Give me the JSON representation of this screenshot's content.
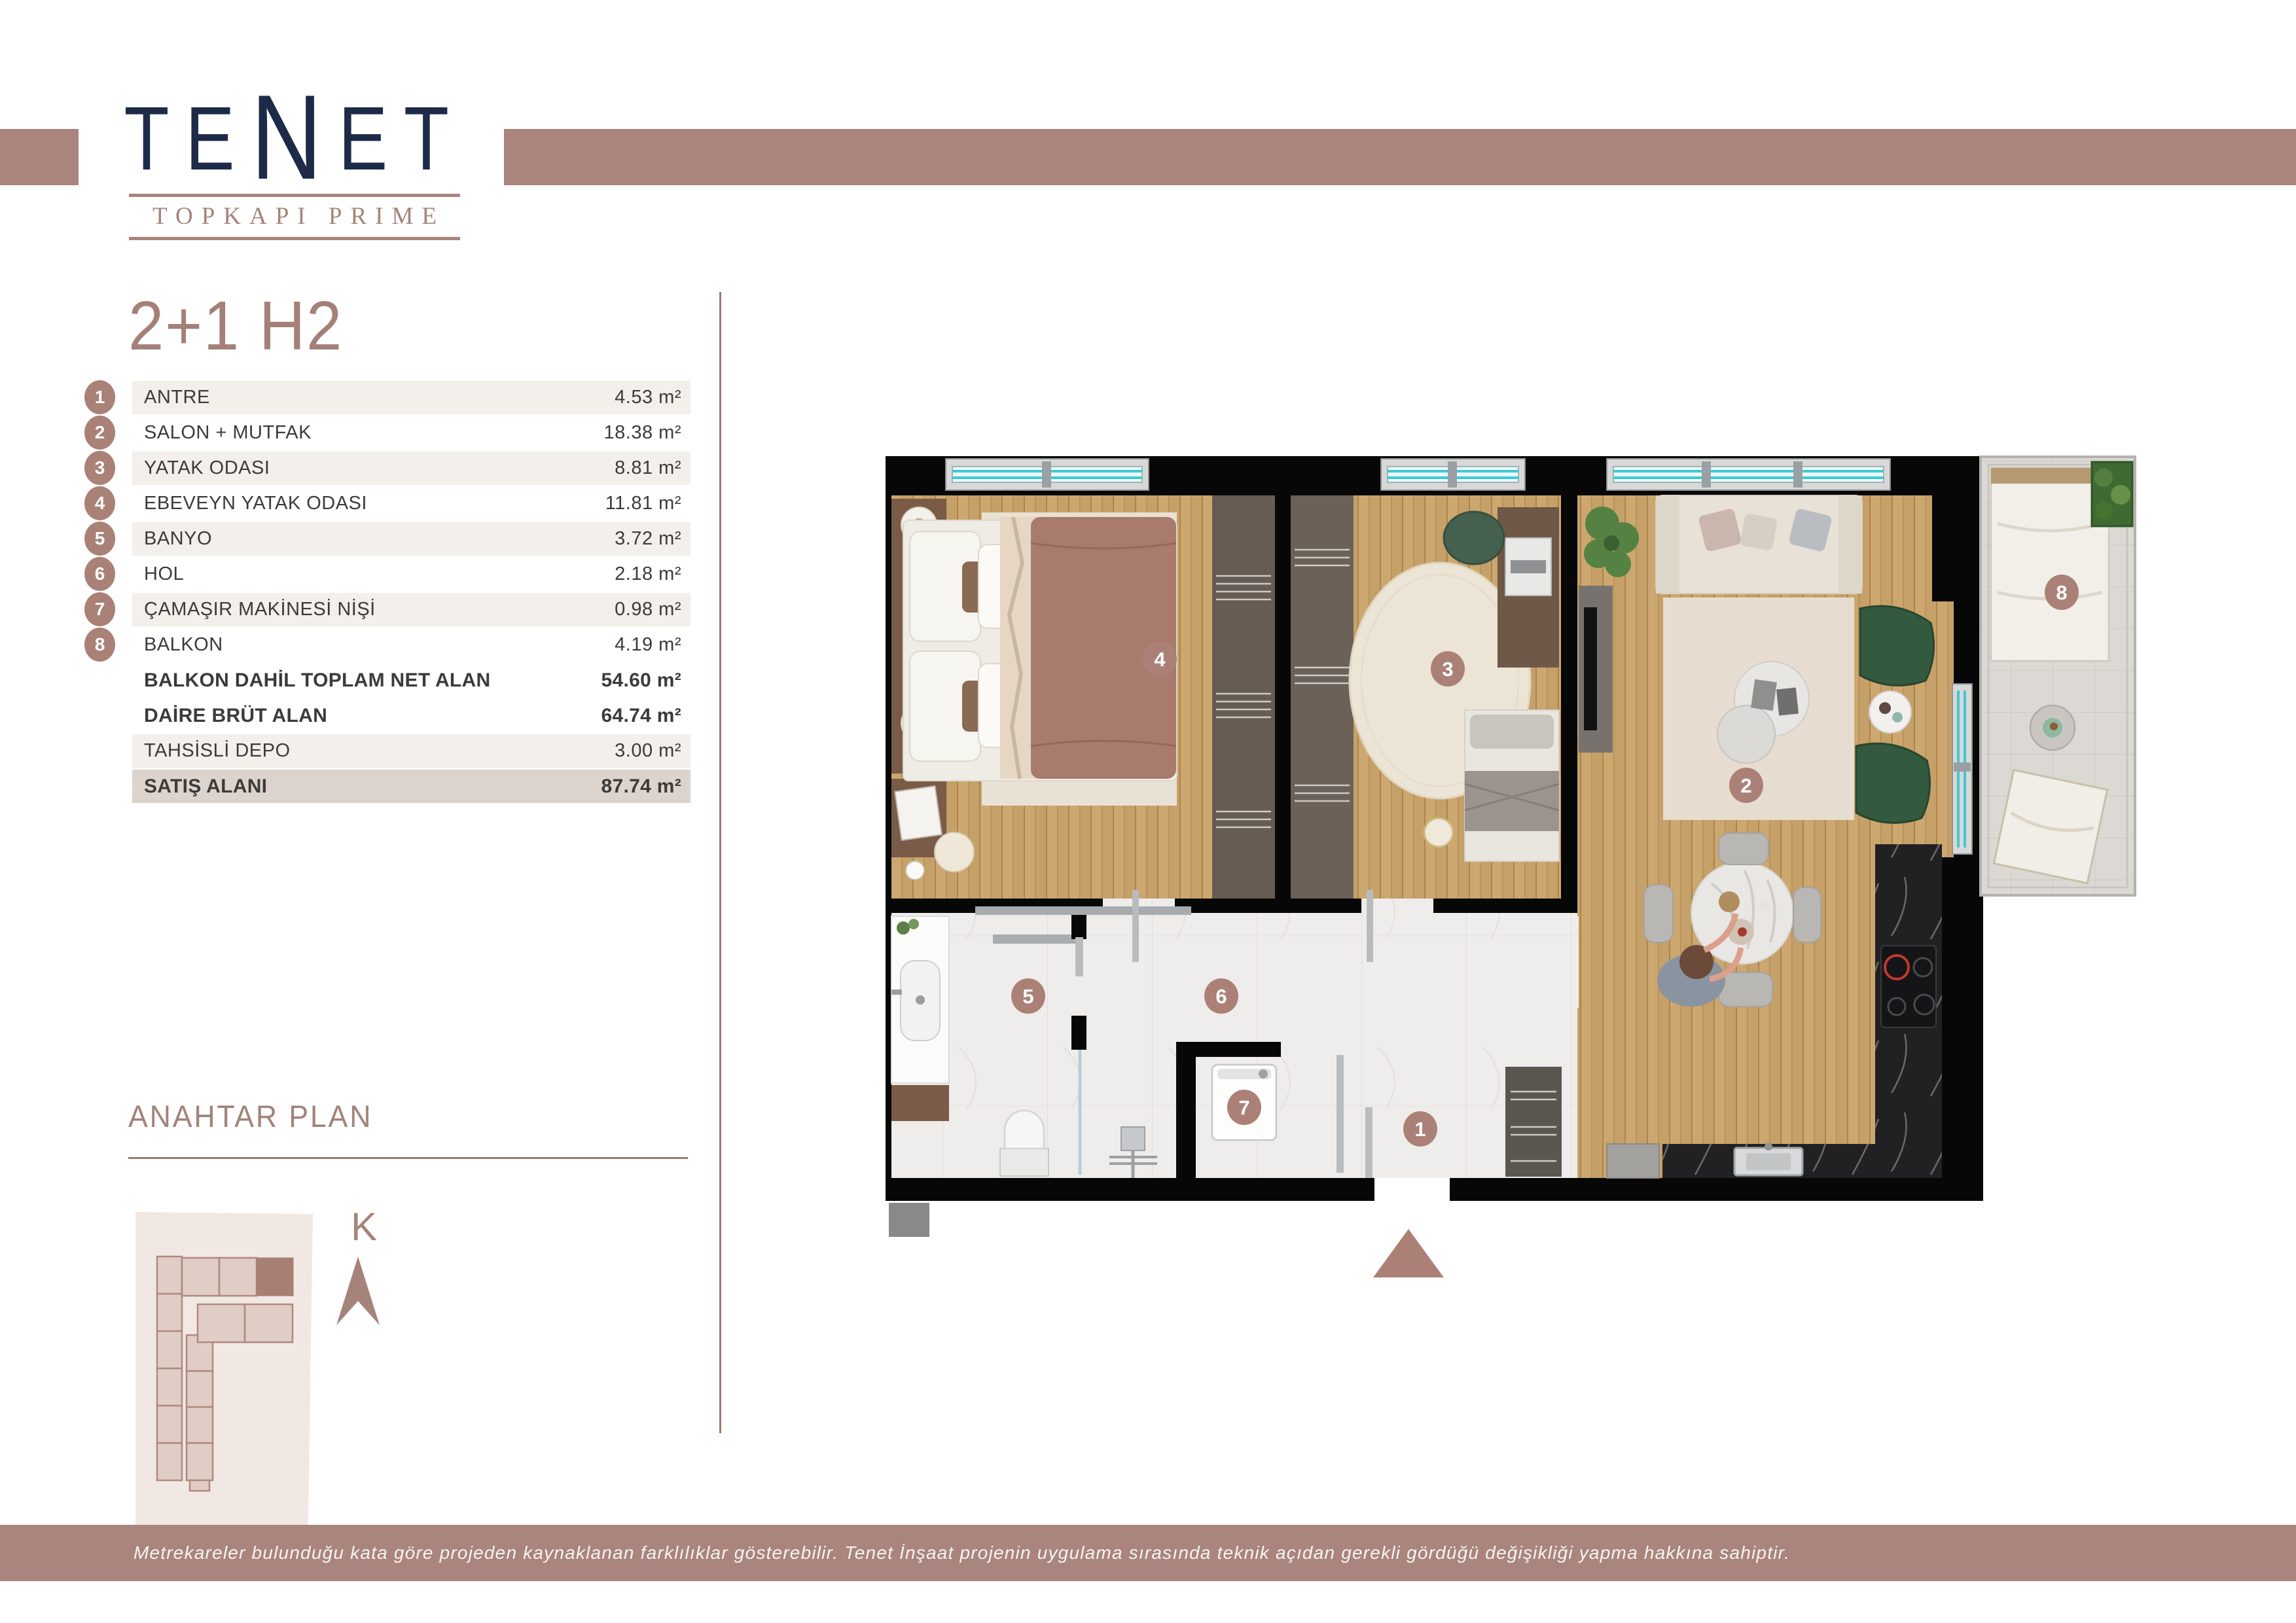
{
  "logo": {
    "brand_letters": [
      "T",
      "E",
      "N",
      "E",
      "T"
    ],
    "sub": "TOPKAPI PRIME"
  },
  "title": "2+1 H2",
  "table": {
    "rows": [
      {
        "num": "1",
        "label": "ANTRE",
        "value": "4.53 m²"
      },
      {
        "num": "2",
        "label": "SALON + MUTFAK",
        "value": "18.38 m²"
      },
      {
        "num": "3",
        "label": "YATAK ODASI",
        "value": "8.81 m²"
      },
      {
        "num": "4",
        "label": "EBEVEYN YATAK ODASI",
        "value": "11.81 m²"
      },
      {
        "num": "5",
        "label": "BANYO",
        "value": "3.72 m²"
      },
      {
        "num": "6",
        "label": "HOL",
        "value": "2.18 m²"
      },
      {
        "num": "7",
        "label": "ÇAMAŞIR MAKİNESİ NİŞİ",
        "value": "0.98 m²"
      },
      {
        "num": "8",
        "label": "BALKON",
        "value": "4.19 m²"
      },
      {
        "num": "",
        "label": "BALKON DAHİL TOPLAM NET ALAN",
        "value": "54.60 m²"
      },
      {
        "num": "",
        "label": "DAİRE BRÜT ALAN",
        "value": "64.74 m²"
      },
      {
        "num": "",
        "label": "TAHSİSLİ DEPO",
        "value": "3.00 m²"
      },
      {
        "num": "",
        "label": "SATIŞ ALANI",
        "value": "87.74 m²"
      }
    ]
  },
  "key_plan": {
    "heading": "ANAHTAR PLAN",
    "compass": "K"
  },
  "plan": {
    "badges": [
      "1",
      "2",
      "3",
      "4",
      "5",
      "6",
      "7",
      "8"
    ]
  },
  "footer": {
    "disclaimer": "Metrekareler bulunduğu kata göre projeden kaynaklanan farklılıklar gösterebilir. Tenet İnşaat projenin uygulama sırasında teknik açıdan gerekli gördüğü değişikliği yapma hakkına sahiptir."
  },
  "colors": {
    "accent": "#a9857d",
    "brand_navy": "#1d2b49",
    "badge": "#aa8177"
  }
}
